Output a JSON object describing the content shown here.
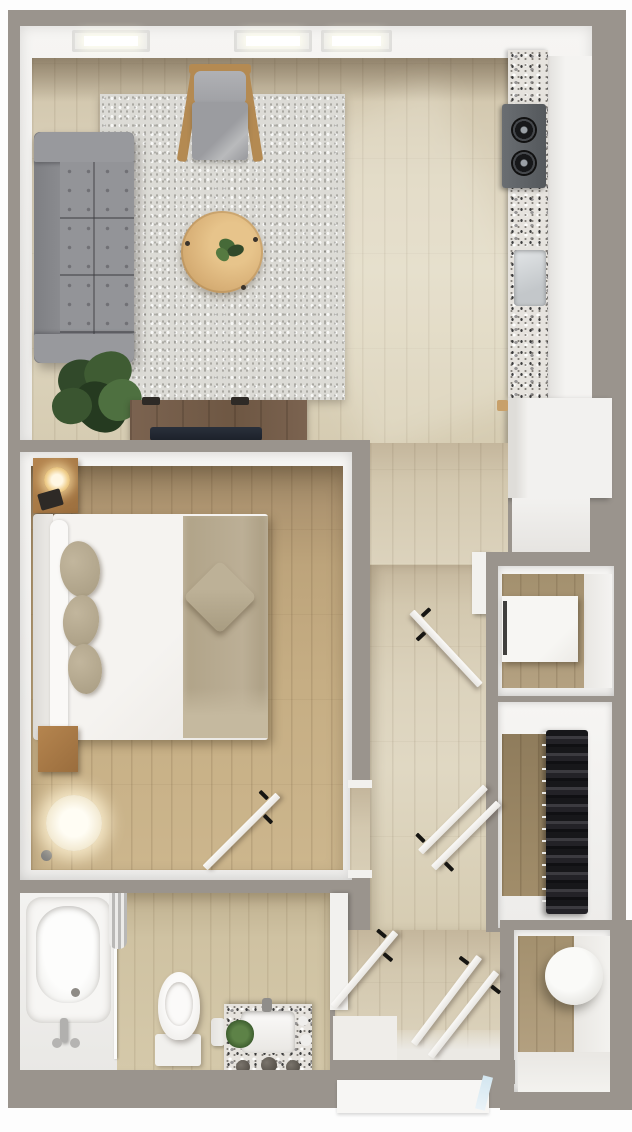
{
  "meta": {
    "type": "floor-plan",
    "description": "Top-down 3D rendered floor plan of a studio / one-bedroom apartment",
    "visible_text": "none",
    "canvas": {
      "width": 632,
      "height": 1132
    }
  },
  "palette": {
    "wall_gray": "#9a948d",
    "page_white": "#fdfdfd",
    "interior_white": "#f3f2f0",
    "floor_pale_wood": "#d9d0ba",
    "floor_warm_wood": "#c2aa80",
    "rug": "#dcdbd6",
    "granite_speckle": "#e6e3de",
    "sofa_gray": "#8f9094",
    "accent_wood": "#b48a52",
    "coffee_table_wood": "#d9b178",
    "plant_green": "#3f5c33",
    "tv_console_wood": "#77604a",
    "blanket_tan": "#b7aa90",
    "clothes_dark": "#1d1d20",
    "door_leaf": "#f4f2ef",
    "door_handle_black": "#161512",
    "glass_blue": "#d3e6f0",
    "lamp_glow": "#fff3d8"
  },
  "rooms": {
    "living_room": {
      "label": "Living Room",
      "furniture": [
        "gray tufted sofa",
        "speckled area rug",
        "wood accent chair with gray cushion",
        "round wood coffee table with plant",
        "potted plant",
        "tv console with tv",
        "three recessed ceiling lights"
      ]
    },
    "kitchen": {
      "label": "Kitchen",
      "furniture": [
        "granite countertop run",
        "two-burner cooktop",
        "undermount sink",
        "refrigerator",
        "base cabinet"
      ]
    },
    "bedroom": {
      "label": "Bedroom",
      "furniture": [
        "queen bed with white sheet and tan blanket",
        "three tan pillows",
        "diamond accent pillow",
        "nightstand with lit lamp and book",
        "wood bench",
        "arc floor lamp"
      ]
    },
    "bathroom": {
      "label": "Bathroom",
      "furniture": [
        "bathtub with faucet",
        "shower curtain and rod",
        "toilet",
        "granite-top vanity with sink, plant and knobs",
        "toilet paper holder"
      ]
    },
    "hallway": {
      "label": "Hallway",
      "furniture": []
    },
    "entry": {
      "label": "Entry",
      "furniture": [
        "threshold",
        "front door mat",
        "glass sidelight"
      ]
    },
    "linen_closet": {
      "label": "Linen Closet",
      "furniture": [
        "white storage cabinet"
      ]
    },
    "walkin_closet": {
      "label": "Closet",
      "furniture": [
        "rod with dark hanging clothes"
      ]
    },
    "utility_closet": {
      "label": "Utility Closet",
      "furniture": [
        "round water heater tank",
        "white platform"
      ]
    }
  },
  "doors": {
    "style": "white swing leaves shown open with black lever handles",
    "count": 7,
    "list": [
      "bedroom door",
      "hallway door near kitchen",
      "closet door upper",
      "closet door lower",
      "bathroom door",
      "entry double leaf A",
      "entry double leaf B"
    ]
  }
}
